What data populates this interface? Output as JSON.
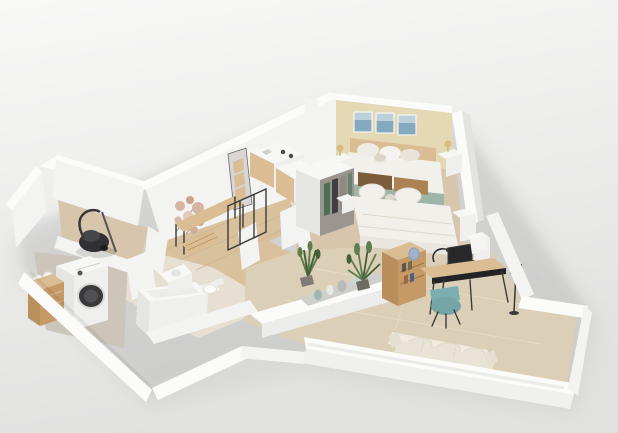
{
  "scene": {
    "type": "3d-isometric-floorplan-render",
    "description": "Photorealistic dollhouse cutaway rendering of an apartment on a plain light background, no visible text",
    "view": "elevated oblique from south-west",
    "text_visible": false
  },
  "palette": {
    "bg_top": "#f8f8f7",
    "bg_bottom": "#e1e1e0",
    "wall_white": "#fbfbfa",
    "wall_face": "#f3f3f2",
    "wall_shade": "#e3e3e1",
    "accent_wall": "#e4d9b4",
    "floor_beige": "#d7c5ac",
    "floor_wood": "#d8c19c",
    "floor_tile_living": "#dccfb7",
    "floor_laundry": "#ccc5b9",
    "floor_bath": "#e7e0d2",
    "wood": "#c59a66",
    "wood_light": "#dabd92",
    "bedding_white": "#f2f0ea",
    "sofa_cream": "#e8e3d4",
    "textile_teal": "#9db6a9",
    "chair_teal": "#7cadaf",
    "pillow_brown": "#7d5c3c",
    "pillow_tan": "#aa8253",
    "plant_green": "#5e7c4c",
    "plant_green_dark": "#455f38",
    "appliance_dark": "#303032",
    "metal_black": "#3b3b3d",
    "art_blue": "#85aabf",
    "art_pink": "#d7b5a4",
    "lamp_gold": "#d8be7e",
    "vase_teal": "#9eb7b3",
    "vase_gray": "#b8bbb9",
    "shadow": "#8f8f8d"
  },
  "rooms": {
    "master_bedroom": {
      "wall": "beige accent",
      "furniture": [
        "triptych-wall-art",
        "double-bed",
        "wood-headboard",
        "teal-throw-blanket",
        "nightstand-left",
        "nightstand-right",
        "table-lamps"
      ]
    },
    "second_bedroom": {
      "furniture": [
        "double-bed",
        "brown-headboard-cushions",
        "open-wardrobe",
        "nightstand",
        "potted-plant",
        "dressers"
      ]
    },
    "kitchen": {
      "furniture": [
        "counter-cabinets",
        "wood-drawer-unit",
        "tall-shelf-unit",
        "cooktop"
      ]
    },
    "hallway": {
      "furniture": [
        "dried-flower-wall-decor",
        "console-table",
        "wood-bench",
        "coat-rack"
      ]
    },
    "storage_room": {
      "furniture": [
        "vacuum-cleaner"
      ]
    },
    "laundry_room": {
      "furniture": [
        "washing-machine",
        "laundry-basket"
      ]
    },
    "bathroom": {
      "furniture": [
        "bathtub",
        "toilet",
        "washbasin"
      ]
    },
    "living_room": {
      "furniture": [
        "desk",
        "laptop",
        "desk-lamp",
        "desk-chair",
        "bookcase-sideboard",
        "blue-vase",
        "potted-palm",
        "low-console-with-vases",
        "sofa",
        "floor-lamp"
      ]
    }
  }
}
